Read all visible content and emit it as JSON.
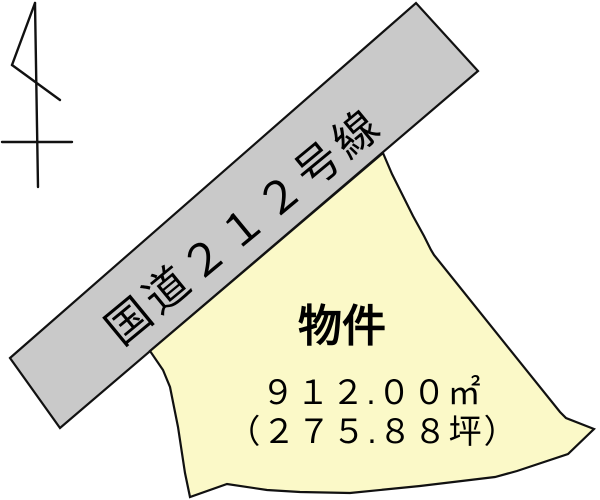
{
  "colors": {
    "background": "#ffffff",
    "road_fill": "#c9c9c9",
    "parcel_fill": "#fbf9c8",
    "outline": "#111111",
    "text": "#000000"
  },
  "road": {
    "label": "国道２１２号線"
  },
  "parcel": {
    "label": "物件",
    "area_m2": "９１２.００㎡",
    "area_tsubo": "（２７５.８８坪）"
  }
}
